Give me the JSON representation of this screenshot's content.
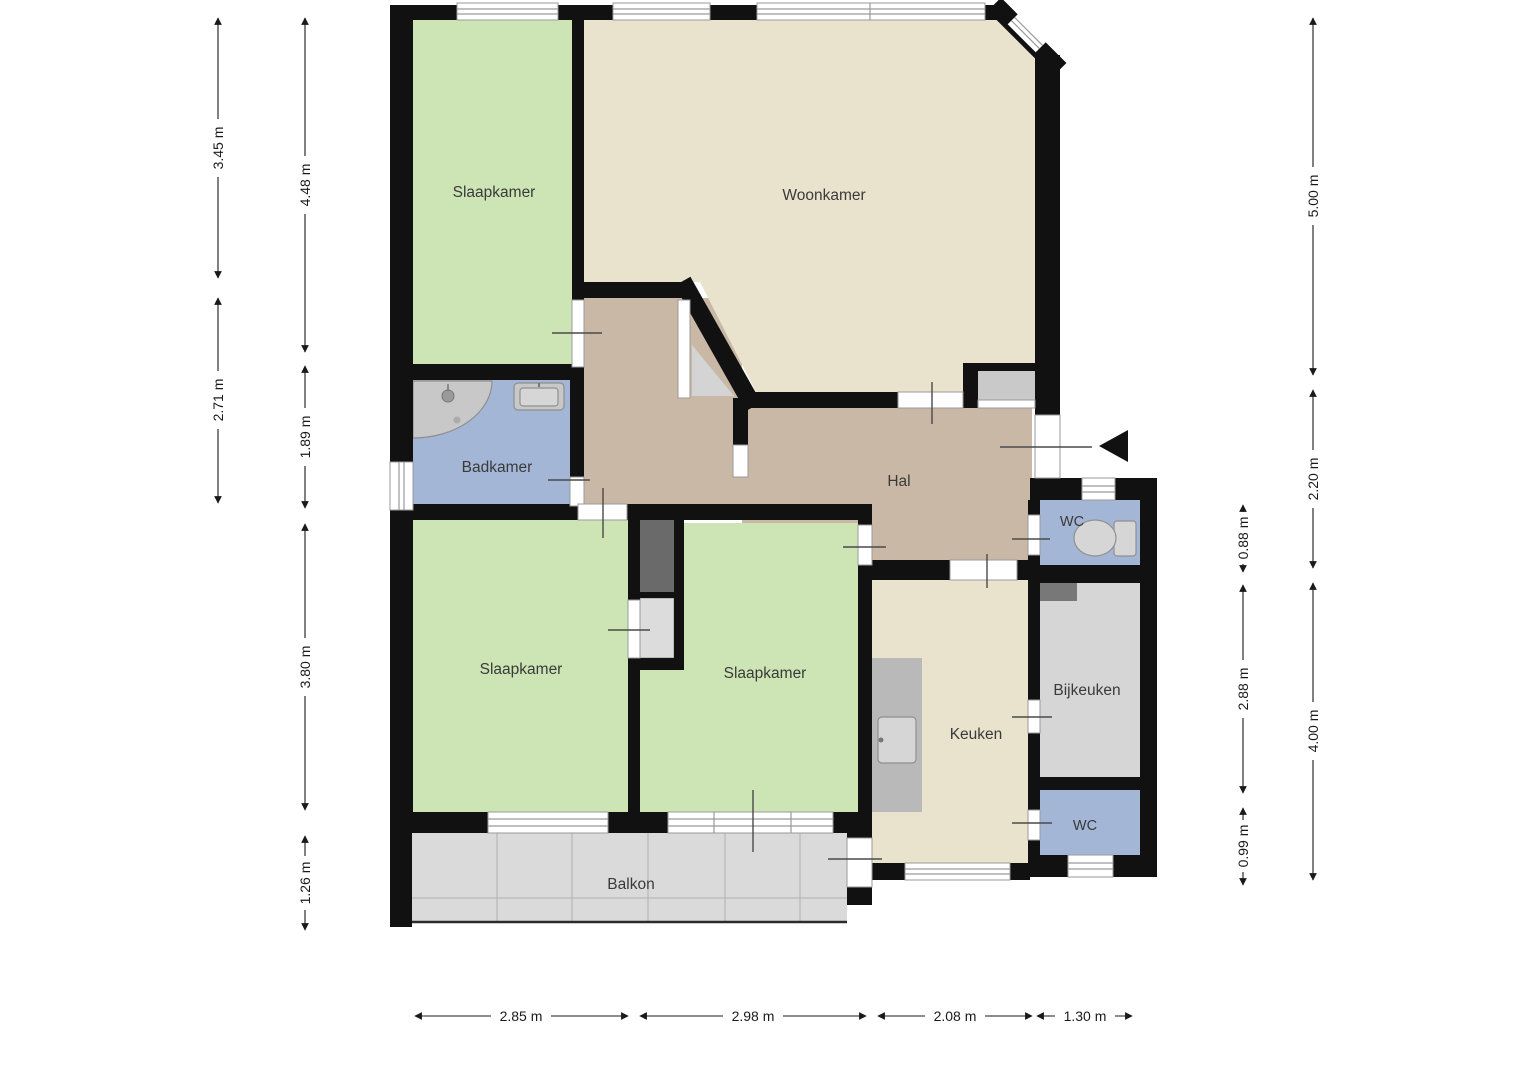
{
  "rooms": {
    "slaapkamer1": "Slaapkamer",
    "woonkamer": "Woonkamer",
    "badkamer": "Badkamer",
    "hal": "Hal",
    "wc1": "WC",
    "slaapkamer2": "Slaapkamer",
    "slaapkamer3": "Slaapkamer",
    "keuken": "Keuken",
    "bijkeuken": "Bijkeuken",
    "wc2": "WC",
    "balkon": "Balkon"
  },
  "dims": {
    "left_outer": [
      "3.45 m",
      "2.71 m"
    ],
    "left_inner": [
      "4.48 m",
      "1.89 m",
      "3.80 m",
      "1.26 m"
    ],
    "right_inner": [
      "0.88 m",
      "2.88 m",
      "0.99 m"
    ],
    "right_outer": [
      "5.00 m",
      "2.20 m",
      "4.00 m"
    ],
    "bottom": [
      "2.85 m",
      "2.98 m",
      "2.08 m",
      "1.30 m"
    ]
  },
  "icons": {
    "entrance_arrow": "left-pointing solid triangle marking entrance"
  },
  "colors": {
    "wall": "#111111",
    "bedroom_green": "#cde5b5",
    "living_beige": "#e9e2cc",
    "hall_tan": "#c9b8a6",
    "bath_blue": "#a3b6d6",
    "utility_gray": "#d6d6d6",
    "balcony_gray": "#dadada",
    "shaft_dark": "#6a6a6a",
    "closet_gray": "#dcdcdc",
    "counter_gray": "#b9b9b9",
    "shelf_dark": "#787878",
    "sill_gray": "#c9c9c9",
    "glass_gray": "#d4d4d4"
  }
}
